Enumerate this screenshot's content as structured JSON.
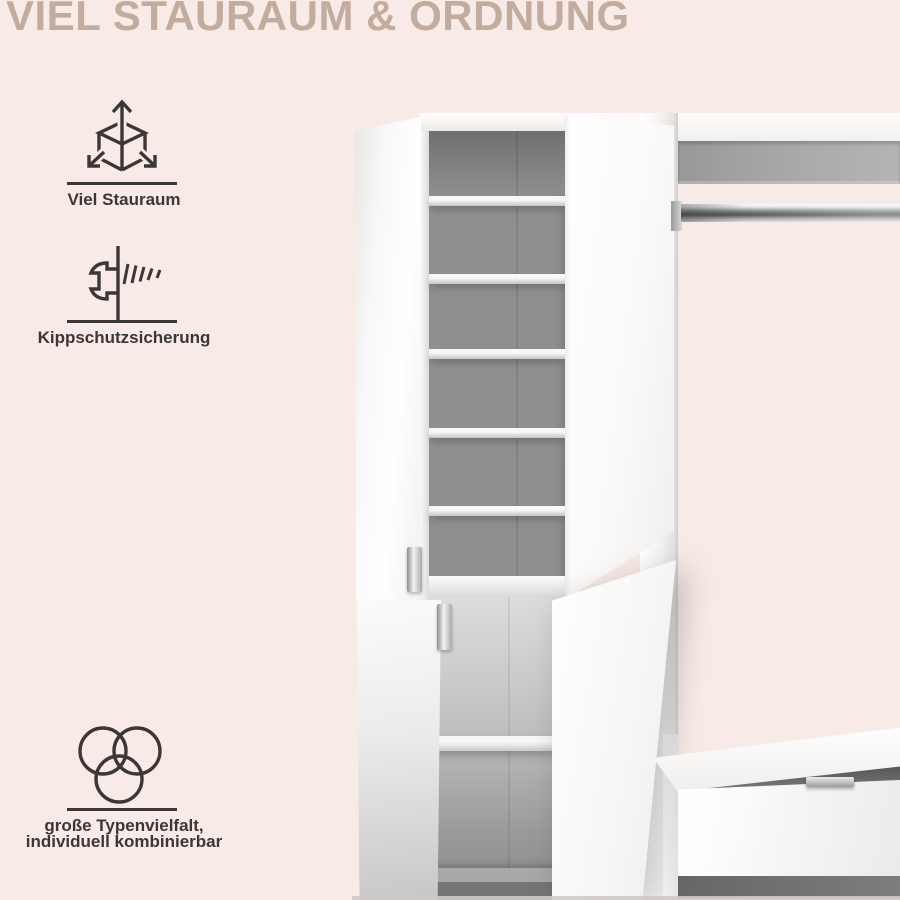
{
  "page": {
    "colors": {
      "background": "#f7eae7",
      "heading": "#c3ac9d",
      "ink": "#3c3737"
    }
  },
  "heading": {
    "title": "VIEL STAURAUM & ORDNUNG"
  },
  "features": [
    {
      "icon": "cube-expand-icon",
      "lines": [
        "Viel Stauraum"
      ]
    },
    {
      "icon": "wall-anchor-screw-icon",
      "lines": [
        "Kippschutzsicherung"
      ]
    },
    {
      "icon": "overlapping-circles-icon",
      "lines": [
        "große Typenvielfalt,",
        "individuell kombinierbar"
      ]
    }
  ],
  "product_photo": {
    "description": "Offener weißer Garderobenschrank mit Regalböden, Kleiderstange und Sitzbank mit Schublade"
  }
}
